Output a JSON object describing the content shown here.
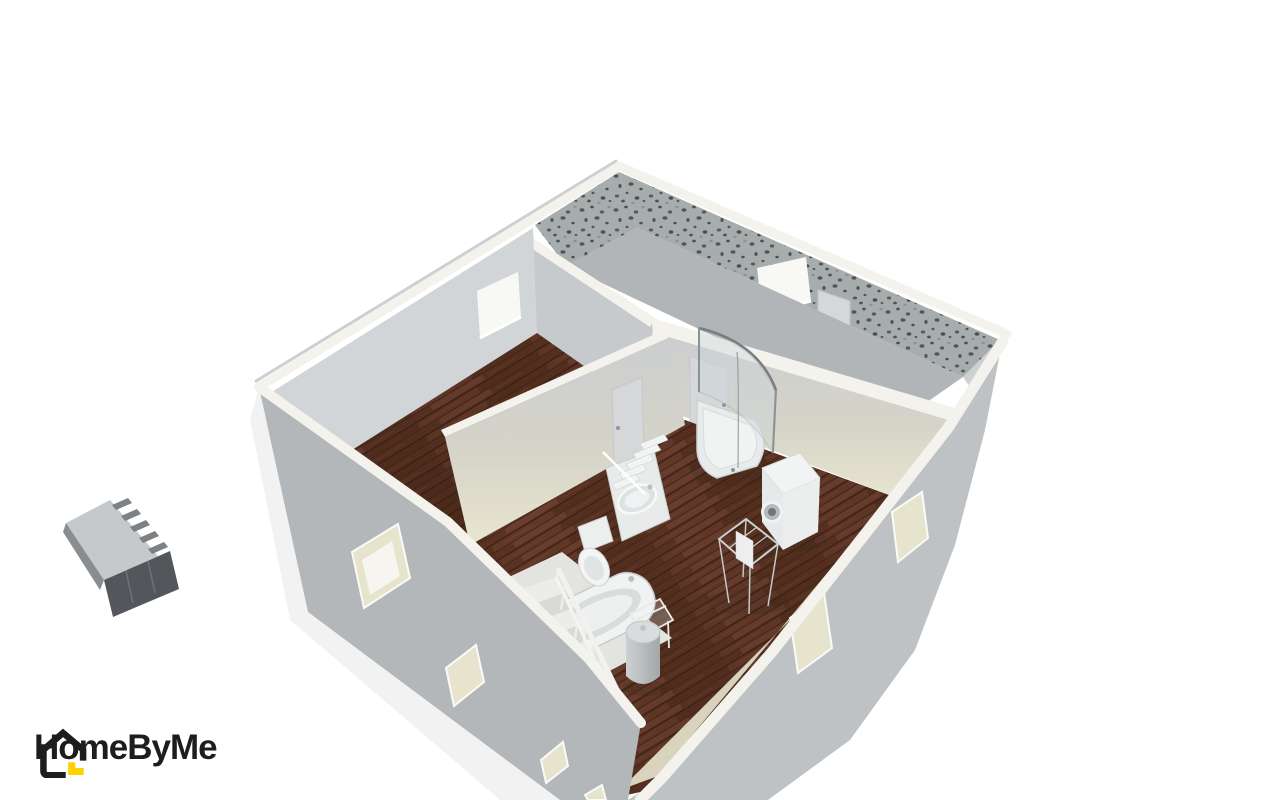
{
  "app": {
    "name": "HomeByMe"
  },
  "logo": {
    "text": "HomeByMe",
    "icon": "house-logo-icon"
  },
  "colors": {
    "background": "#ffffff",
    "wall_outer": "#b4b7ba",
    "wall_outer_light": "#bfc2c4",
    "wall_top": "#f3f2ec",
    "wall_interior": "#c7cacc",
    "wall_interior_light": "#d2d5d7",
    "wall_cream": "#e8e5cf",
    "window_reveal": "#e7e4cd",
    "window_glass": "#f8f8f5",
    "wallpaper_base": "#a7acac",
    "wallpaper_speckle": "#52585a",
    "floor_concrete": "#b2b5b7",
    "floor_wood": "#5c3424",
    "floor_wood_light": "#6d4030",
    "floor_wood_dark": "#3f2115",
    "fixture_white": "#f1f3f3",
    "fixture_shadow": "#d8dcdd",
    "glass": "#cdd6da",
    "metal": "#8b9296",
    "door_leaf": "#d5d7d9",
    "stair_tread": "#e9e9e5",
    "logo_black": "#1d1d1b",
    "logo_yellow": "#ffd100",
    "furniture_top": "#c6c9cb",
    "furniture_front": "#53575b"
  },
  "scene": {
    "type": "3d-floor-plan-render",
    "view": "aerial-oblique",
    "rooms": [
      {
        "name": "bedroom",
        "floor": "dark hardwood",
        "walls": "light gray",
        "openings": [
          "window"
        ]
      },
      {
        "name": "back room",
        "floor": "bare gray",
        "walls": "gray speckled wallpaper",
        "openings": [
          "window",
          "door"
        ]
      },
      {
        "name": "bathroom",
        "floor": "dark hardwood",
        "walls": "cream",
        "openings": [
          "door to bedroom",
          "door to back room"
        ]
      }
    ],
    "bathroom_fixtures": [
      "corner shower",
      "washing machine",
      "bathroom scale",
      "toilet",
      "vanity with washbasin",
      "shelf tower",
      "bathtub",
      "laundry bin",
      "clothes drying rack",
      "wire shelf"
    ],
    "other": [
      "staircase with white balustrade",
      "floating wall desk"
    ]
  }
}
